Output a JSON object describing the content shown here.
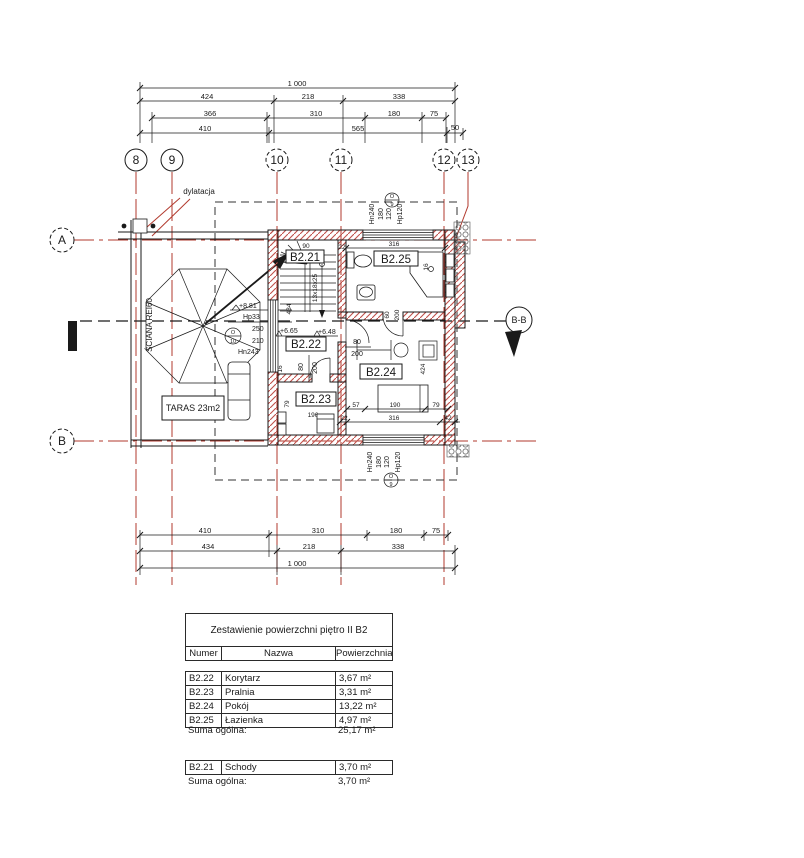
{
  "colors": {
    "axis_red": "#b23a2e",
    "hatch_red": "#c0504a",
    "ink": "#1a1a1a"
  },
  "drawing": {
    "grid_cols": [
      "8",
      "9",
      "10",
      "11",
      "12",
      "13"
    ],
    "grid_rows": [
      "A",
      "B"
    ],
    "section_label": "B-B",
    "dylatacja_label": "dylatacja",
    "dim_top": {
      "r1": [
        "1 000"
      ],
      "r2": [
        "424",
        "218",
        "338"
      ],
      "r3": [
        "366",
        "310",
        "180",
        "75"
      ],
      "r4": [
        "410",
        "565",
        "50"
      ]
    },
    "dim_bottom": {
      "r1": [
        "410",
        "310",
        "180",
        "75"
      ],
      "r2": [
        "434",
        "218",
        "338"
      ],
      "r3": [
        "1 000"
      ]
    },
    "terrace": {
      "label": "TARAS 23m2",
      "wall_label": "ŚCIANA REI60",
      "level": "+8.81",
      "hp": "Hp33",
      "door_w": "250",
      "door_h": "210",
      "hn": "Hn243",
      "sym_top": "O",
      "sym_no": "10"
    },
    "window": {
      "sym_top": "O",
      "sym_no": "9",
      "hn": "Hn240",
      "w": "180",
      "h": "120",
      "hp": "Hp120"
    },
    "stairs": {
      "label": "B2.21",
      "steps": "13x18x25",
      "lv1": "+6.65",
      "lv2": "+6.48",
      "run": "434",
      "d90": "90",
      "d22": "22"
    },
    "rooms": {
      "corridor": "B2.22",
      "laundry": "B2.23",
      "room": "B2.24",
      "bath": "B2.25"
    },
    "doors": {
      "w": "80",
      "h": "200"
    },
    "dims": {
      "d316": "316",
      "d16": "16",
      "d200": "200",
      "d60": "60",
      "d424": "424",
      "d57": "57",
      "d190": "190",
      "d79": "79",
      "d22": "22",
      "d42": "42",
      "d196": "196"
    }
  },
  "tables": {
    "area": {
      "title": "Zestawienie powierzchni piętro II B2",
      "headers": [
        "Numer",
        "Nazwa",
        "Powierzchnia"
      ],
      "rows": [
        [
          "B2.22",
          "Korytarz",
          "3,67 m²"
        ],
        [
          "B2.23",
          "Pralnia",
          "3,31 m²"
        ],
        [
          "B2.24",
          "Pokój",
          "13,22 m²"
        ],
        [
          "B2.25",
          "Łazienka",
          "4,97 m²"
        ]
      ],
      "total_label": "Suma ogólna:",
      "total_value": "25,17 m²"
    },
    "stairs": {
      "rows": [
        [
          "B2.21",
          "Schody",
          "3,70 m²"
        ]
      ],
      "total_label": "Suma ogólna:",
      "total_value": "3,70 m²"
    }
  }
}
